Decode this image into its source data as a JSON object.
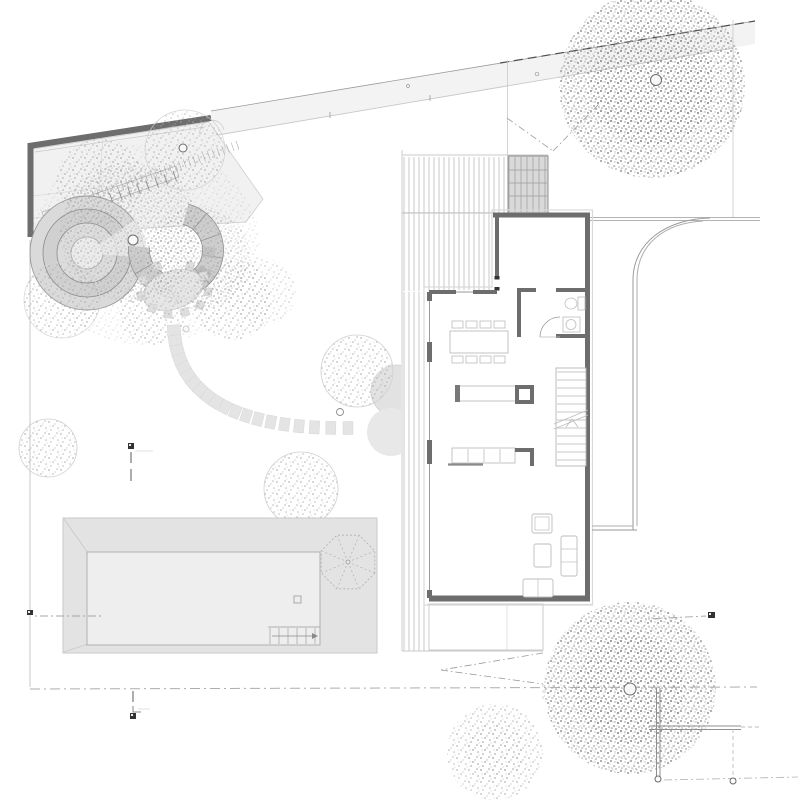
{
  "drawing": {
    "kind": "architectural site / ground floor plan",
    "visible_text": [],
    "notes": "no legible text labels; four small dark section-cut markers around plot"
  },
  "colors": {
    "wall": "#6d6d6d",
    "line": "#9a9a9a",
    "faint": "#c8c8c8",
    "xfaint": "#d9d9d9",
    "furn": "#bdbdbd",
    "dash_dark": "#4f4f4f",
    "marker": "#333333",
    "band": "#f3f3f3",
    "bed": "#efefef",
    "steps": "#d9d9d9",
    "deck_line": "#c5c5c5",
    "pool_deck": "#e3e3e3",
    "water": "#eeeeee",
    "stone": "#e4e4e4",
    "ring_outer": "#dadada",
    "ring_mid": "#d0d0d0",
    "ring_in": "#dcdcdc",
    "ring_core": "#ebebeb",
    "segment_ring": "#c9c9c9",
    "tree_dot_light": "#a9a9a9",
    "tree_dot_dark": "#8f8f8f"
  },
  "counts": {
    "dining_chairs": 8,
    "stepping_stones": 20,
    "stair_treads": 12,
    "pool_steps": 6,
    "parasol_ribs": 8,
    "section_markers": 4,
    "large_trees": 2,
    "medium_trees": 6
  },
  "generated": {
    "deck_top": {
      "type": "vlines",
      "x": 404,
      "y": 157,
      "w": 100,
      "h": 56,
      "gap": 5
    },
    "deck_mid": {
      "type": "vlines",
      "x": 404,
      "y": 214,
      "w": 88,
      "h": 77,
      "gap": 5
    },
    "deck_side": {
      "type": "vlines",
      "x": 404,
      "y": 292,
      "w": 20,
      "h": 359,
      "gap": 5
    },
    "entry_steps": {
      "type": "vlines",
      "x": 509,
      "y": 157,
      "w": 38,
      "h": 55,
      "gap": 6
    },
    "pool_steps": {
      "type": "vlines",
      "x": 270,
      "y": 628,
      "w": 50,
      "h": 16,
      "gap": 9
    },
    "counter_div": {
      "type": "vlines",
      "x": 468,
      "y": 449,
      "w": 32,
      "h": 13,
      "gap": 16
    },
    "stair_treads": {
      "type": "hlines",
      "x": 557,
      "y": 372,
      "w": 29,
      "h": 90,
      "gap": 8
    },
    "ladder_main": {
      "type": "rungs",
      "a": [
        46,
        215
      ],
      "b": [
        173,
        171
      ],
      "n": 14,
      "len": 11
    },
    "ladder_dotted": {
      "type": "rungs",
      "a": [
        92,
        191
      ],
      "b": [
        236,
        141
      ],
      "n": 30,
      "len": 9
    },
    "parasol_ribs": {
      "type": "radial",
      "cx": 348,
      "cy": 562,
      "r": 28,
      "n": 8,
      "rot": 0.3927
    },
    "stones": {
      "type": "stones",
      "start": [
        174,
        330
      ],
      "control": [
        180,
        430
      ],
      "end": [
        348,
        428
      ],
      "count": 20,
      "size": 10
    }
  }
}
